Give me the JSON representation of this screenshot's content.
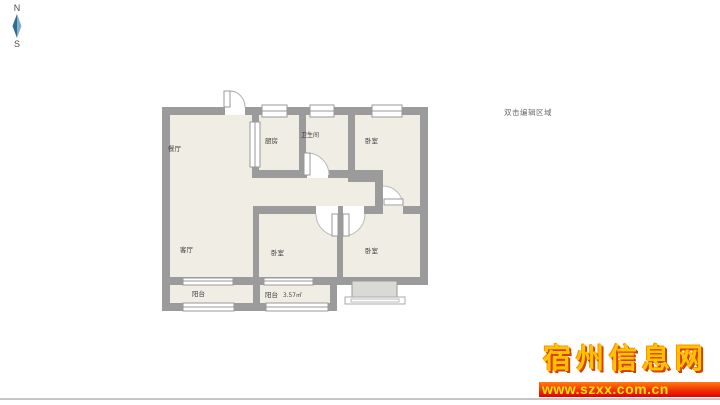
{
  "compass": {
    "north_label": "N",
    "south_label": "S",
    "needle_dark": "#2f6b93",
    "needle_light": "#7fb0d2"
  },
  "floor_plan": {
    "edit_hint": "双击编辑区域",
    "wall_color": "#9b9b9b",
    "room_fill": "#f0ede5",
    "rooms": [
      {
        "name": "dining-room",
        "label": "餐厅"
      },
      {
        "name": "kitchen",
        "label": "厨房"
      },
      {
        "name": "bathroom",
        "label": "卫生间"
      },
      {
        "name": "bedroom-top-right",
        "label": "卧室"
      },
      {
        "name": "living-room",
        "label": "客厅"
      },
      {
        "name": "bedroom-bottom-middle",
        "label": "卧室"
      },
      {
        "name": "bedroom-bottom-right",
        "label": "卧室"
      },
      {
        "name": "balcony-left",
        "label": "阳台"
      },
      {
        "name": "balcony-middle",
        "label": "阳台",
        "area": "3.57㎡"
      }
    ]
  },
  "watermark": {
    "site_name": "宿州信息网",
    "site_url": "www.szxx.com.cn",
    "banner_top_color": "#ff7d12",
    "banner_bottom_color": "#e00000",
    "text_color": "#ffe400"
  }
}
